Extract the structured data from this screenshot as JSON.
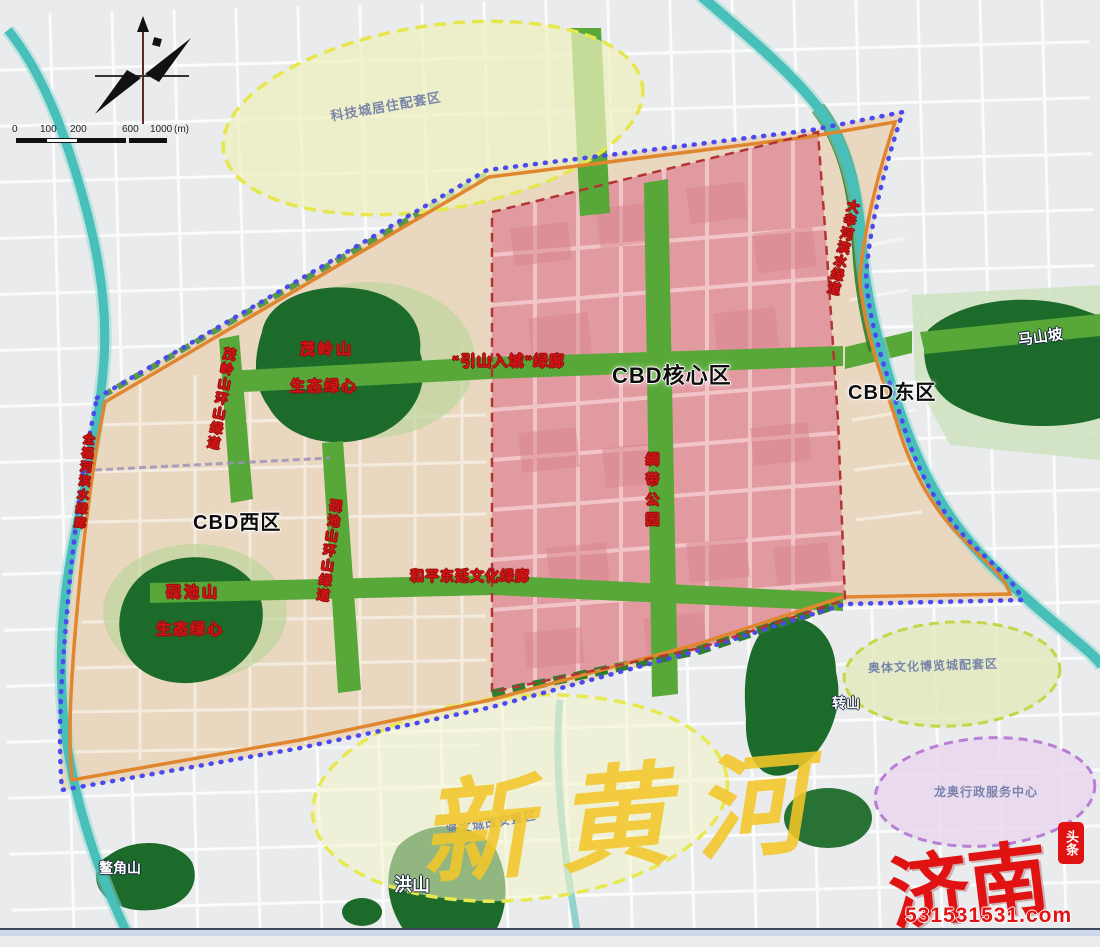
{
  "scale_bar": {
    "ticks": [
      "0",
      "100",
      "200",
      "600",
      "1000"
    ],
    "unit": "(m)"
  },
  "zones": {
    "cbd_core": "CBD核心区",
    "cbd_west": "CBD西区",
    "cbd_east": "CBD东区"
  },
  "green_hearts": {
    "maoling_line1": "茂岭山",
    "maoling_line2": "生态绿心",
    "yanchi_line1": "砚池山",
    "yanchi_line2": "生态绿心"
  },
  "corridors": {
    "yinshan": "“引山入城”绿廊",
    "heping": "和平东延文化绿廊",
    "ribbon_park": "绸带公园",
    "maoling_ring": "茂岭山环山绿道",
    "yanchi_ring": "砚池山环山绿道",
    "quanfu_river": "全福河滨水绿廊",
    "daxin_river": "大辛河滨水绿道"
  },
  "districts": {
    "keji": "科技城居住配套区",
    "aoti": "奥体文化博览城配套区",
    "longao": "龙奥行政服务中心",
    "xianwen": "贤文城改安置区"
  },
  "mountains": {
    "mashan": "马山坡",
    "zhuanshan": "转山",
    "hongshan": "洪山",
    "aojiao": "鳌角山"
  },
  "watermark": {
    "river": "新黄河",
    "brand": "济南",
    "badge": "头条",
    "site": "531531531.com"
  },
  "colors": {
    "boundary_blue": "#4a4aee",
    "boundary_orange": "#e0862e",
    "core_pink": "#e29aa1",
    "core_border_red": "#b23434",
    "zone_beige": "#ead7c0",
    "corridor_green": "#57a838",
    "mountain_green": "#1d6b2b",
    "river_teal": "#49bfba",
    "ellipse_yellow_stroke": "#e6e64e",
    "ellipse_purple_stroke": "#b97fd6",
    "label_red": "#d31515",
    "brand_red": "#e01212"
  }
}
